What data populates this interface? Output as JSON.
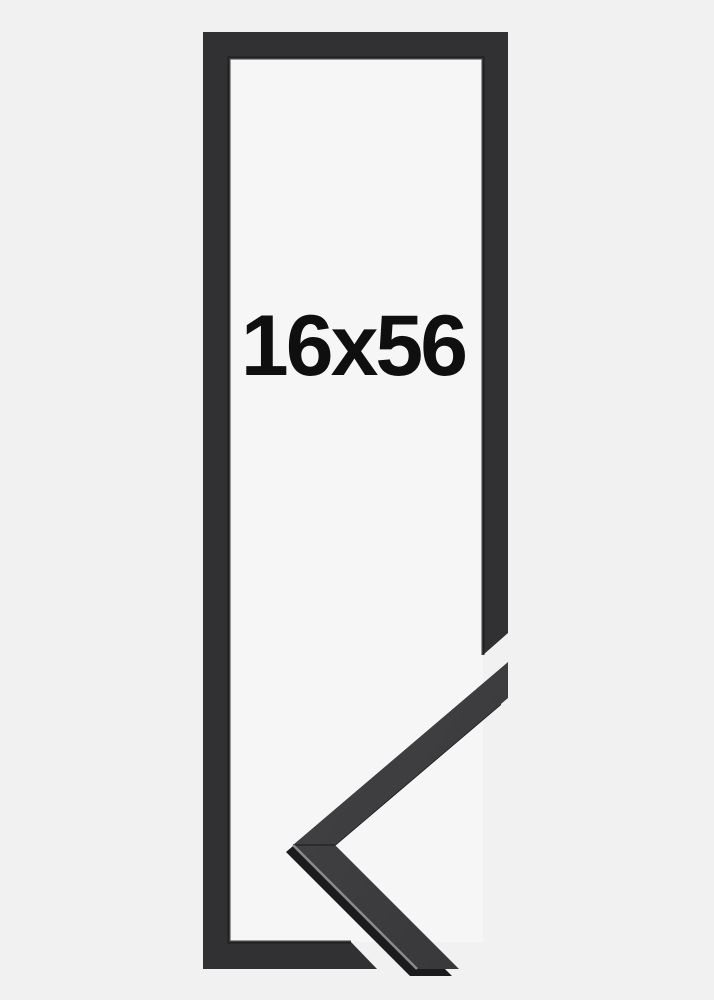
{
  "product": {
    "size_label": "16x56"
  },
  "colors": {
    "background": "#f1f1f2",
    "inner_area": "#f6f6f7",
    "frame_face": "#313133",
    "frame_inner_shadow": "#1d1d1f",
    "sample_face_light": "#434345",
    "sample_face_dark": "#37373a",
    "sample_depth": "#1b1b1d",
    "sample_highlight": "#96969a",
    "sample_seam": "#2a2a2c",
    "label_text": "#0f0f0f"
  }
}
